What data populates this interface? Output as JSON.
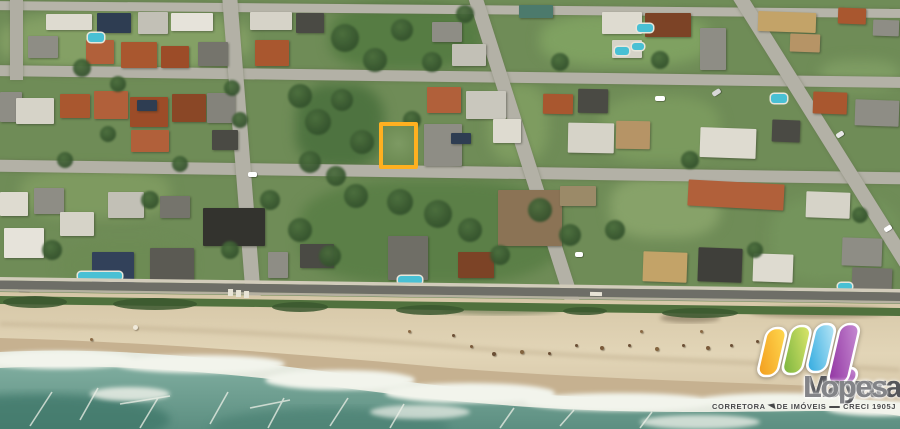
{
  "image": {
    "kind": "aerial-satellite-photo",
    "subject": "beachfront neighborhood with highlighted vacant lot for sale",
    "width": 900,
    "height": 429
  },
  "highlight_lot": {
    "x": 379,
    "y": 122,
    "w": 39,
    "h": 47,
    "border_color": "#ffb020",
    "border_px": 4,
    "fill": "#7d9a63"
  },
  "logo": {
    "name_primary": "Mayara",
    "name_secondary": "Lopes",
    "name_primary_color": "#55565a",
    "name_secondary_color": "#838488",
    "tagline_left": "CORRETORA",
    "tagline_mid": "DE IMÓVEIS",
    "tagline_right": "CRECI 1905J",
    "tagline_color": "#47484a",
    "mark_colors": {
      "bar1_top": "#ffd94f",
      "bar1_bottom": "#f29a1c",
      "bar2_top": "#dce66a",
      "bar2_bottom": "#74b13c",
      "bar3_top": "#b8e6f6",
      "bar3_bottom": "#29a7de",
      "bar4_top": "#c68bd2",
      "bar4_bottom": "#8e2f9f",
      "outline": "#ffffff"
    }
  },
  "palette": {
    "grass_base": "#6f8c57",
    "street": "#b3b1a6",
    "road_asphalt": "#6e6e67",
    "sidewalk": "#d2ccbb",
    "dune_grass": "#50713d",
    "sand": "#d9cbac",
    "sand_light": "#e2d5b7",
    "wet_sand": "#c6b190",
    "foam": "#e6eae0",
    "water": "#679c8e",
    "water_deep": "#4c8173"
  },
  "map": {
    "patches": [
      [
        0,
        12,
        250,
        58,
        "#84a065"
      ],
      [
        330,
        4,
        152,
        66,
        "#567c43"
      ],
      [
        540,
        14,
        170,
        52,
        "#7fa161"
      ],
      [
        296,
        84,
        88,
        84,
        "#4e7340"
      ],
      [
        488,
        84,
        60,
        78,
        "#7e9c60"
      ],
      [
        600,
        96,
        120,
        66,
        "#7b9a5e"
      ],
      [
        300,
        180,
        260,
        104,
        "#5b7f47"
      ],
      [
        610,
        176,
        110,
        62,
        "#87a269"
      ],
      [
        20,
        168,
        150,
        50,
        "#7e9a60"
      ],
      [
        770,
        196,
        130,
        86,
        "#74945c"
      ],
      [
        60,
        240,
        130,
        50,
        "#6d8b54"
      ],
      [
        820,
        60,
        80,
        30,
        "#7e9c63"
      ]
    ],
    "streets": [
      [
        -10,
        5,
        920,
        9,
        0.5,
        "#b6b4a9"
      ],
      [
        -10,
        71,
        920,
        11,
        0.75,
        "#b3b1a6"
      ],
      [
        -10,
        166,
        920,
        12,
        0.8,
        "#b3b1a6"
      ],
      [
        10,
        0,
        13,
        80,
        0,
        "#b0aea3"
      ],
      [
        234,
        -8,
        15,
        310,
        -4.5,
        "#b3b1a6"
      ],
      [
        518,
        -12,
        14,
        330,
        -17.7,
        "#b3b1a6"
      ],
      [
        814,
        -34,
        14,
        322,
        -32,
        "#b3b1a6"
      ]
    ],
    "houses": [
      [
        28,
        36,
        30,
        22,
        "#8e8d85",
        0
      ],
      [
        46,
        14,
        46,
        16,
        "#dedbd0",
        0
      ],
      [
        97,
        13,
        34,
        20,
        "#2e3d52",
        0
      ],
      [
        138,
        12,
        30,
        22,
        "#c2c0b6",
        0
      ],
      [
        86,
        40,
        28,
        24,
        "#b1603a",
        0
      ],
      [
        121,
        42,
        36,
        26,
        "#a9572f",
        0
      ],
      [
        161,
        46,
        28,
        22,
        "#9c4c28",
        0
      ],
      [
        171,
        13,
        42,
        18,
        "#e6e3da",
        0
      ],
      [
        198,
        42,
        30,
        24,
        "#75746c",
        0
      ],
      [
        250,
        12,
        42,
        18,
        "#d6d3c8",
        0
      ],
      [
        296,
        13,
        28,
        20,
        "#4a4a44",
        0
      ],
      [
        255,
        40,
        34,
        26,
        "#a9572f",
        0
      ],
      [
        432,
        22,
        30,
        20,
        "#8e8d85",
        0
      ],
      [
        452,
        44,
        34,
        22,
        "#c2c0b6",
        0
      ],
      [
        519,
        5,
        34,
        13,
        "#4c7a6c",
        0
      ],
      [
        602,
        12,
        40,
        22,
        "#dedbd0",
        0
      ],
      [
        612,
        40,
        30,
        18,
        "#d6d3c8",
        0
      ],
      [
        645,
        13,
        46,
        24,
        "#7c4326",
        0
      ],
      [
        700,
        28,
        26,
        42,
        "#8e8d85",
        0
      ],
      [
        758,
        12,
        58,
        20,
        "#c3a368",
        2
      ],
      [
        790,
        34,
        30,
        18,
        "#b69466",
        2
      ],
      [
        873,
        20,
        26,
        16,
        "#8e8d85",
        2
      ],
      [
        838,
        8,
        28,
        16,
        "#a9572f",
        2
      ],
      [
        0,
        92,
        22,
        30,
        "#8e8d85",
        0
      ],
      [
        16,
        98,
        38,
        26,
        "#d6d3c8",
        0
      ],
      [
        60,
        94,
        30,
        24,
        "#a9572f",
        0
      ],
      [
        94,
        91,
        34,
        28,
        "#b1603a",
        0
      ],
      [
        130,
        97,
        38,
        30,
        "#9c4c28",
        0
      ],
      [
        172,
        94,
        34,
        28,
        "#8a4726",
        0
      ],
      [
        131,
        130,
        38,
        22,
        "#b1603a",
        0
      ],
      [
        207,
        93,
        28,
        30,
        "#84837b",
        0
      ],
      [
        212,
        130,
        26,
        20,
        "#4a4a44",
        0
      ],
      [
        427,
        87,
        34,
        26,
        "#b1603a",
        0
      ],
      [
        466,
        91,
        40,
        28,
        "#c9c7bd",
        0
      ],
      [
        424,
        124,
        38,
        42,
        "#8e8d85",
        0
      ],
      [
        493,
        119,
        28,
        24,
        "#dedbd0",
        0
      ],
      [
        543,
        94,
        30,
        20,
        "#a9572f",
        1
      ],
      [
        578,
        89,
        30,
        24,
        "#4a4a44",
        1
      ],
      [
        568,
        123,
        46,
        30,
        "#d6d3c8",
        1
      ],
      [
        616,
        121,
        34,
        28,
        "#b69466",
        1
      ],
      [
        700,
        128,
        56,
        30,
        "#dedbd0",
        2
      ],
      [
        772,
        120,
        28,
        22,
        "#4a4a44",
        2
      ],
      [
        813,
        92,
        34,
        22,
        "#a9572f",
        2
      ],
      [
        855,
        100,
        44,
        26,
        "#8e8d85",
        2
      ],
      [
        137,
        100,
        20,
        11,
        "#2e3d52",
        0
      ],
      [
        451,
        133,
        20,
        11,
        "#2e3d52",
        0
      ],
      [
        0,
        192,
        28,
        24,
        "#dedbd0",
        0
      ],
      [
        34,
        188,
        30,
        26,
        "#8e8d85",
        0
      ],
      [
        4,
        228,
        40,
        30,
        "#e6e3da",
        0
      ],
      [
        60,
        212,
        34,
        24,
        "#d6d3c8",
        0
      ],
      [
        108,
        192,
        36,
        26,
        "#c2c0b6",
        0
      ],
      [
        160,
        196,
        30,
        22,
        "#75746c",
        0
      ],
      [
        92,
        252,
        42,
        34,
        "#32415a",
        0
      ],
      [
        150,
        248,
        44,
        32,
        "#5b5a53",
        0
      ],
      [
        203,
        208,
        62,
        38,
        "#33332e",
        0
      ],
      [
        268,
        252,
        20,
        26,
        "#8e8d85",
        0
      ],
      [
        300,
        244,
        34,
        24,
        "#4a4a44",
        0
      ],
      [
        388,
        236,
        40,
        44,
        "#6f6e66",
        0
      ],
      [
        458,
        252,
        36,
        26,
        "#7c4326",
        0
      ],
      [
        498,
        190,
        64,
        56,
        "#8b7355",
        0
      ],
      [
        560,
        186,
        36,
        20,
        "#9b8a68",
        0
      ],
      [
        643,
        252,
        44,
        30,
        "#c3a368",
        2
      ],
      [
        698,
        248,
        44,
        34,
        "#3f3f3a",
        2
      ],
      [
        753,
        254,
        40,
        28,
        "#dedbd0",
        2
      ],
      [
        688,
        182,
        96,
        26,
        "#b1603a",
        3
      ],
      [
        806,
        192,
        44,
        26,
        "#d6d3c8",
        2
      ],
      [
        842,
        238,
        40,
        28,
        "#8e8d85",
        2
      ],
      [
        852,
        268,
        40,
        22,
        "#75746c",
        2
      ]
    ],
    "pools": [
      [
        88,
        33,
        16,
        9
      ],
      [
        637,
        24,
        16,
        8
      ],
      [
        615,
        47,
        14,
        8
      ],
      [
        632,
        43,
        12,
        7
      ],
      [
        771,
        94,
        16,
        9
      ],
      [
        78,
        272,
        44,
        8
      ],
      [
        398,
        276,
        24,
        8
      ],
      [
        838,
        283,
        14,
        7
      ]
    ],
    "trees": [
      [
        82,
        68,
        9
      ],
      [
        118,
        84,
        8
      ],
      [
        232,
        88,
        8
      ],
      [
        300,
        96,
        12
      ],
      [
        318,
        122,
        13
      ],
      [
        342,
        100,
        11
      ],
      [
        362,
        142,
        12
      ],
      [
        310,
        162,
        11
      ],
      [
        336,
        176,
        10
      ],
      [
        356,
        196,
        12
      ],
      [
        400,
        202,
        13
      ],
      [
        438,
        214,
        14
      ],
      [
        470,
        230,
        12
      ],
      [
        300,
        230,
        12
      ],
      [
        330,
        256,
        11
      ],
      [
        270,
        200,
        10
      ],
      [
        150,
        200,
        9
      ],
      [
        52,
        250,
        10
      ],
      [
        615,
        230,
        10
      ],
      [
        660,
        60,
        9
      ],
      [
        690,
        160,
        9
      ],
      [
        860,
        215,
        8
      ],
      [
        432,
        62,
        10
      ],
      [
        402,
        30,
        11
      ],
      [
        465,
        14,
        9
      ],
      [
        560,
        62,
        9
      ],
      [
        345,
        38,
        14
      ],
      [
        375,
        60,
        12
      ],
      [
        412,
        120,
        9
      ],
      [
        540,
        210,
        12
      ],
      [
        570,
        235,
        11
      ],
      [
        500,
        255,
        10
      ],
      [
        230,
        250,
        9
      ],
      [
        180,
        164,
        8
      ],
      [
        65,
        160,
        8
      ],
      [
        755,
        250,
        8
      ],
      [
        108,
        134,
        8
      ],
      [
        240,
        120,
        8
      ]
    ],
    "cars": [
      [
        655,
        96,
        10,
        5,
        "#ffffff",
        0
      ],
      [
        248,
        172,
        9,
        5,
        "#ffffff",
        1
      ],
      [
        575,
        252,
        8,
        5,
        "#ffffff",
        0
      ],
      [
        836,
        132,
        8,
        5,
        "#e8e8e8",
        -32
      ],
      [
        884,
        226,
        8,
        5,
        "#ffffff",
        -32
      ],
      [
        18,
        286,
        12,
        6,
        "#3a3a36",
        1
      ],
      [
        524,
        288,
        9,
        5,
        "#ffffff",
        1
      ],
      [
        712,
        90,
        9,
        5,
        "#d8d8d8",
        -32
      ]
    ],
    "road_marks": [
      [
        228,
        289,
        5,
        7,
        1,
        "#e8e4d6"
      ],
      [
        236,
        290,
        5,
        7,
        1,
        "#e8e4d6"
      ],
      [
        244,
        291,
        5,
        7,
        1,
        "#e8e4d6"
      ],
      [
        590,
        292,
        12,
        4,
        1,
        "#e8e4d6"
      ]
    ],
    "beach_dots": [
      [
        133,
        325,
        5,
        "#efe9da"
      ],
      [
        90,
        338,
        3,
        "#8a6a45"
      ],
      [
        452,
        334,
        3,
        "#6b4f35"
      ],
      [
        470,
        345,
        3,
        "#7a5a3a"
      ],
      [
        492,
        352,
        4,
        "#6b4f35"
      ],
      [
        520,
        350,
        4,
        "#83643f"
      ],
      [
        548,
        352,
        3,
        "#6b4f35"
      ],
      [
        575,
        344,
        3,
        "#6b4f35"
      ],
      [
        600,
        346,
        4,
        "#7a5a3a"
      ],
      [
        628,
        344,
        3,
        "#6b4f35"
      ],
      [
        655,
        347,
        4,
        "#83643f"
      ],
      [
        682,
        344,
        3,
        "#6b4f35"
      ],
      [
        706,
        346,
        4,
        "#7a5a3a"
      ],
      [
        730,
        344,
        3,
        "#6b4f35"
      ],
      [
        756,
        340,
        3,
        "#6b4f35"
      ],
      [
        700,
        330,
        3,
        "#8a6a45"
      ],
      [
        640,
        330,
        3,
        "#8a6a45"
      ],
      [
        408,
        330,
        3,
        "#8a6a45"
      ]
    ]
  }
}
